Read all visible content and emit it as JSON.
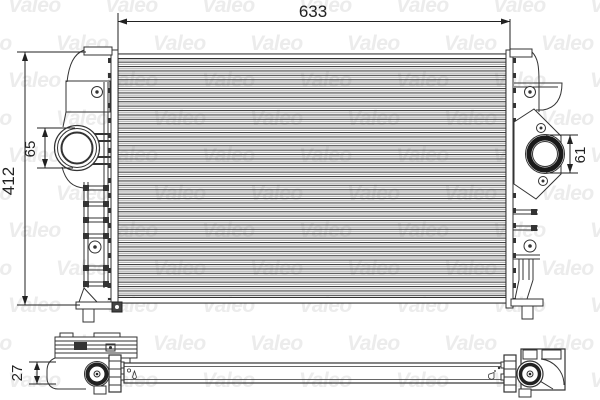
{
  "brand": "Valeo",
  "watermark": {
    "text": "Valeo",
    "color": "#ececec",
    "font_size": 21,
    "rows": 11,
    "cols": 7,
    "col_step": 97,
    "row_step": 37.5,
    "x0": 8,
    "y0": -6,
    "odd_offset": -49
  },
  "dimensions": {
    "core_width": "633",
    "overall_height": "412",
    "left_port_diameter": "65",
    "right_port_diameter": "61",
    "core_depth": "27"
  },
  "colors": {
    "line": "#333333",
    "dark_fill": "#222222",
    "fin_dark": "#404040",
    "fin_light": "#9a9a9a",
    "watermark": "#ececec",
    "background": "#ffffff"
  }
}
